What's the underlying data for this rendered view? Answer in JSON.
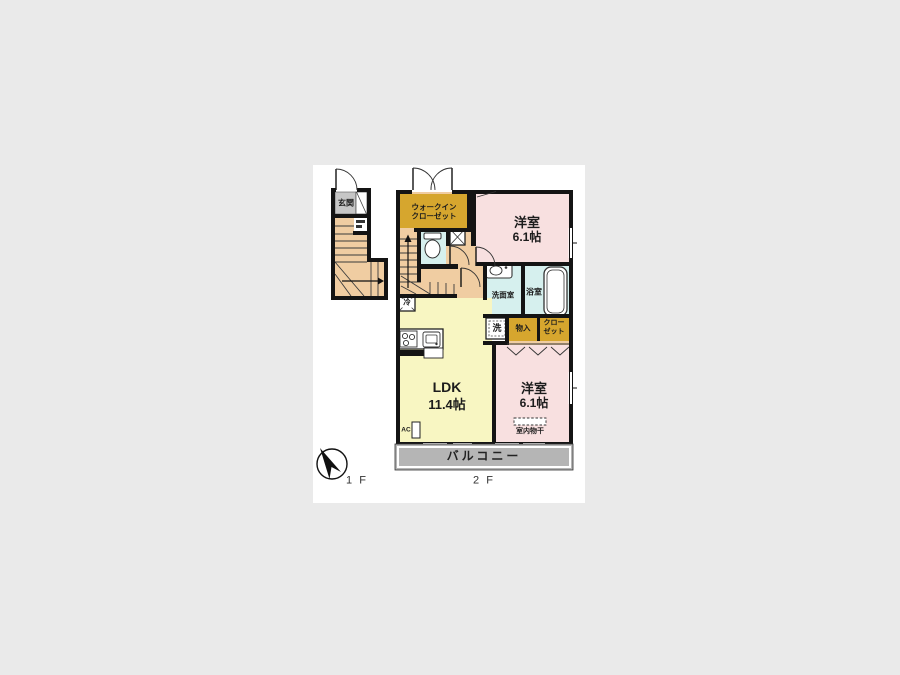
{
  "plan": {
    "floor1": {
      "floor_label": "1 F",
      "entrance": "玄関"
    },
    "floor2": {
      "floor_label": "2 F",
      "walk_in_closet_line1": "ウォークイン",
      "walk_in_closet_line2": "クローゼット",
      "bedroom_top_name": "洋室",
      "bedroom_top_size": "6.1帖",
      "bedroom_bottom_name": "洋室",
      "bedroom_bottom_size": "6.1帖",
      "ldk_name": "LDK",
      "ldk_size": "11.4帖",
      "washroom": "洗面室",
      "bathroom": "浴室",
      "washer": "洗",
      "storage": "物入",
      "closet_line1": "クロー",
      "closet_line2": "ゼット",
      "fridge": "冷",
      "ac": "AC",
      "indoor_drying": "室内物干",
      "balcony": "バルコニー"
    },
    "icons": {
      "north_arrow": "compass-north-arrow",
      "toilet": "toilet-icon",
      "bathtub": "bathtub-icon",
      "sink": "sink-icon",
      "stove": "stove-icon",
      "kitchen_sink": "kitchen-sink-icon"
    },
    "colors": {
      "wall": "#141414",
      "room_pink": "#f8e0e0",
      "room_yellow": "#f8f6c2",
      "room_cyan": "#d6f0ee",
      "room_peach": "#f0cda2",
      "room_orange": "#d6a62e",
      "entrance_gray": "#c6c6c6",
      "balcony_gray": "#b5b5b5",
      "background": "#eaeaea"
    }
  }
}
